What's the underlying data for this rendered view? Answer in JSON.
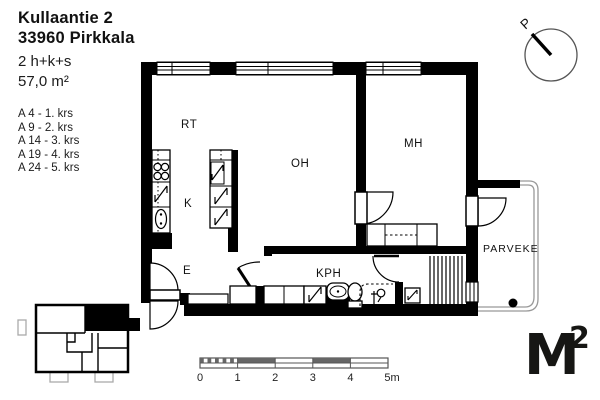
{
  "header": {
    "address_line1": "Kullaantie 2",
    "address_line2": "33960 Pirkkala",
    "apartment_type": "2 h+k+s",
    "area": "57,0 m²"
  },
  "apartments": [
    "A 4 - 1. krs",
    "A 9 - 2. krs",
    "A 14 - 3. krs",
    "A 19 - 4. krs",
    "A 24 - 5. krs"
  ],
  "rooms": {
    "rt": "RT",
    "k": "K",
    "oh": "OH",
    "mh": "MH",
    "e": "E",
    "kph": "KPH",
    "parveke": "PARVEKE"
  },
  "compass": {
    "label": "P"
  },
  "scale_bar": {
    "ticks": [
      "0",
      "1",
      "2",
      "3",
      "4",
      "5m"
    ]
  },
  "logo": {
    "m": "M",
    "sup": "2"
  },
  "colors": {
    "walls": "#000000",
    "background": "#ffffff",
    "scale_fill": "#666666",
    "railing": "#999999",
    "keymap_gray": "#aaaaaa"
  }
}
